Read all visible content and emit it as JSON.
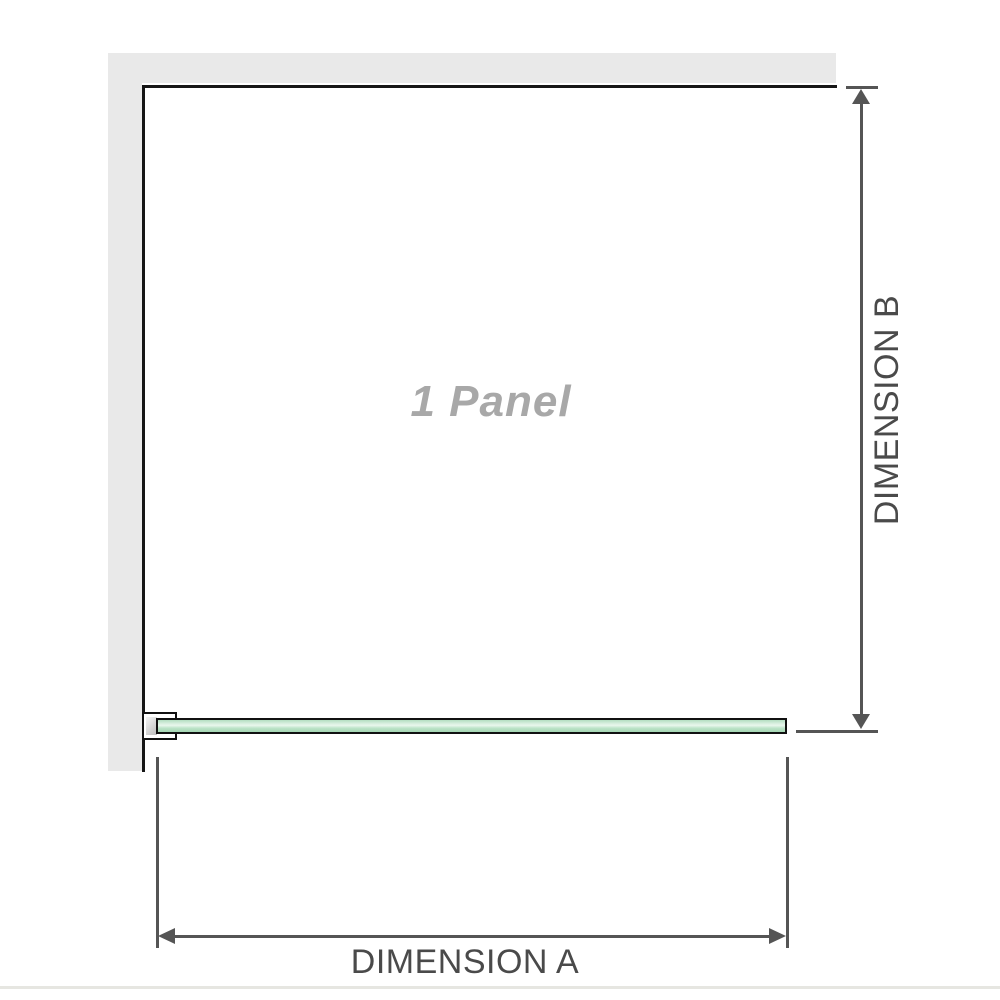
{
  "diagram": {
    "panel_label": "1 Panel",
    "dimension_a": {
      "label": "DIMENSION A"
    },
    "dimension_b": {
      "label": "DIMENSION B"
    },
    "icons": {
      "arrow_up": "arrow-up-icon",
      "arrow_down": "arrow-down-icon",
      "arrow_left": "arrow-left-icon",
      "arrow_right": "arrow-right-icon"
    },
    "colors": {
      "wall": "#e9e9e9",
      "panel_border": "#161616",
      "glass_border": "#111111",
      "glass_light": "#e9f7ed",
      "glass_mid": "#bce3c8",
      "glass_dark": "#a4d6b3",
      "bracket_metal": "#bdbdbd",
      "dimension_line": "#555555",
      "dimension_text": "#4a4a4a",
      "watermark_text": "#a8a8a8",
      "baseline": "#e6e6e1"
    }
  }
}
